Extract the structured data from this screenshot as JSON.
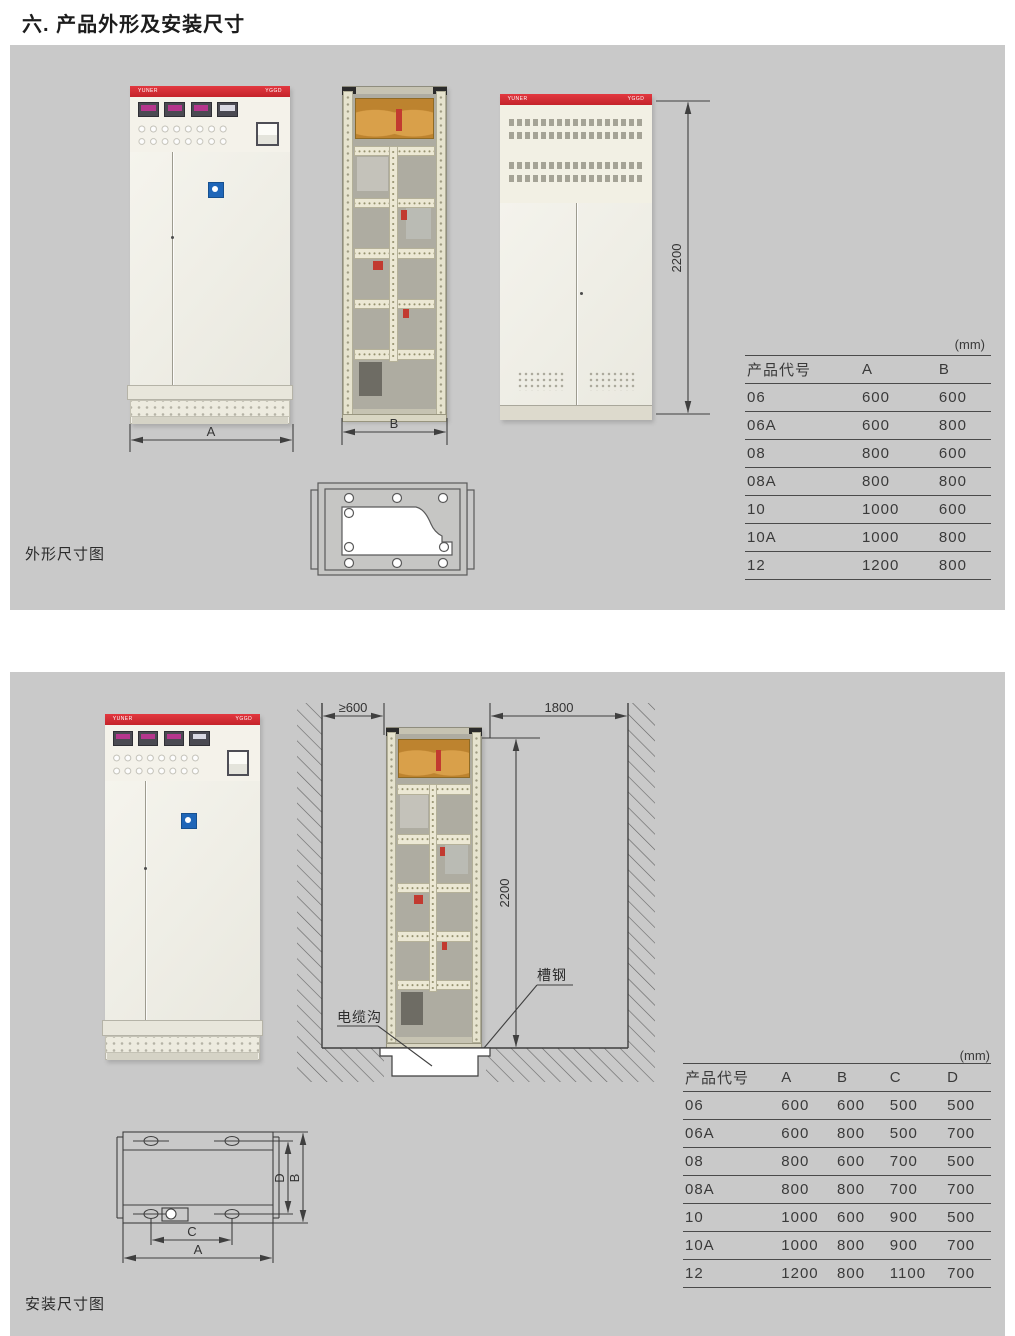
{
  "title": "六. 产品外形及安装尺寸",
  "brand": {
    "left": "YUNER",
    "right": "YGGD"
  },
  "colors": {
    "accent_red": "#d7282e",
    "panel_gray": "#c9c9c9",
    "logo_blue": "#1f66b8",
    "line": "#3f3f3f"
  },
  "outline": {
    "caption": "外形尺寸图",
    "unit": "(mm)",
    "dims": {
      "a": "A",
      "b": "B",
      "height": "2200"
    },
    "table": {
      "headers": [
        "产品代号",
        "A",
        "B"
      ],
      "rows": [
        [
          "06",
          "600",
          "600"
        ],
        [
          "06A",
          "600",
          "800"
        ],
        [
          "08",
          "800",
          "600"
        ],
        [
          "08A",
          "800",
          "800"
        ],
        [
          "10",
          "1000",
          "600"
        ],
        [
          "10A",
          "1000",
          "800"
        ],
        [
          "12",
          "1200",
          "800"
        ]
      ]
    }
  },
  "install": {
    "caption": "安装尺寸图",
    "unit": "(mm)",
    "dims": {
      "left_clearance": "≥600",
      "rear_clearance": "1800",
      "height": "2200",
      "plan_a": "A",
      "plan_b": "B",
      "plan_c": "C",
      "plan_d": "D"
    },
    "labels": {
      "cable_trench": "电缆沟",
      "channel_steel": "槽钢"
    },
    "table": {
      "headers": [
        "产品代号",
        "A",
        "B",
        "C",
        "D"
      ],
      "rows": [
        [
          "06",
          "600",
          "600",
          "500",
          "500"
        ],
        [
          "06A",
          "600",
          "800",
          "500",
          "700"
        ],
        [
          "08",
          "800",
          "600",
          "700",
          "500"
        ],
        [
          "08A",
          "800",
          "800",
          "700",
          "700"
        ],
        [
          "10",
          "1000",
          "600",
          "900",
          "500"
        ],
        [
          "10A",
          "1000",
          "800",
          "900",
          "700"
        ],
        [
          "12",
          "1200",
          "800",
          "1100",
          "700"
        ]
      ]
    }
  }
}
